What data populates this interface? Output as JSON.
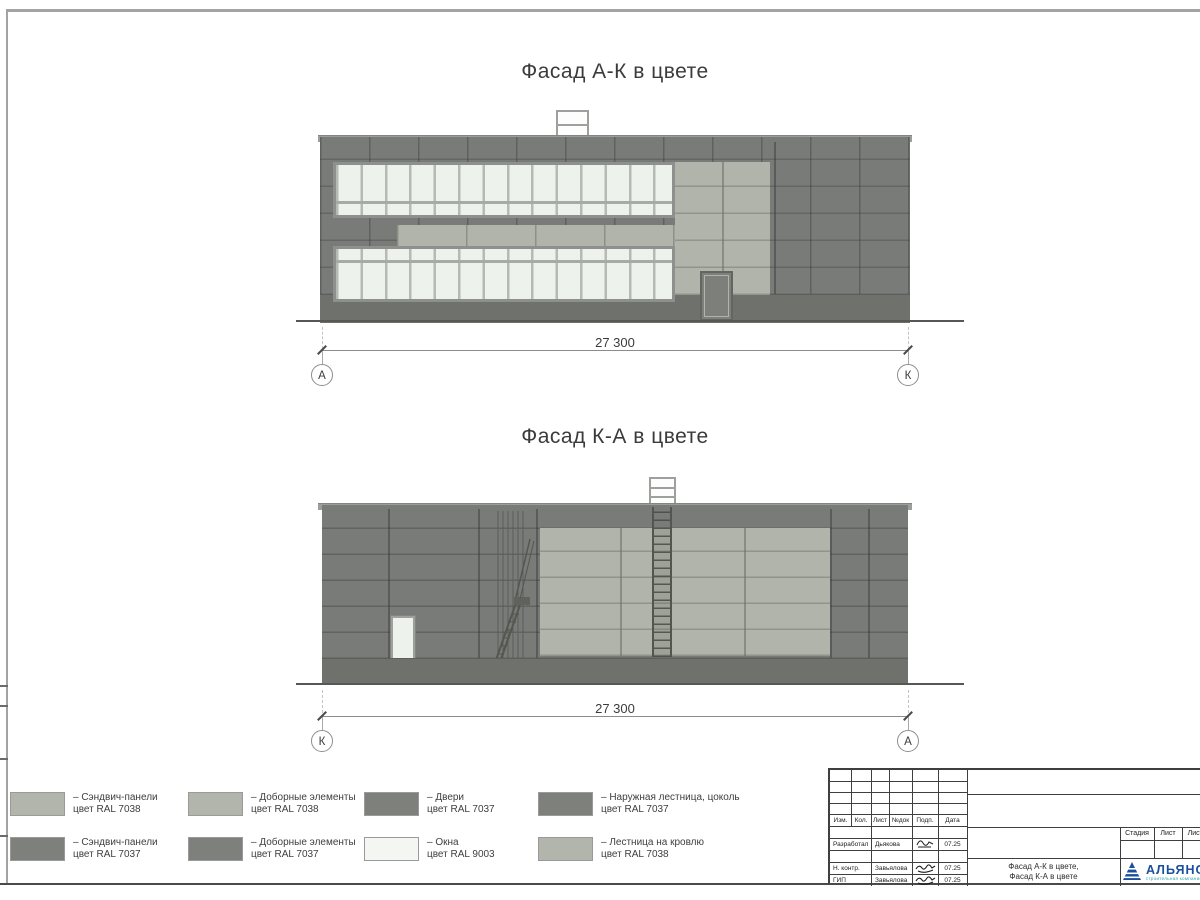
{
  "colors": {
    "panel_dark": "#787b77",
    "panel_light": "#b0b4aa",
    "window_pane": "#eef2ec",
    "window_frame": "#8d908c",
    "mullion": "#b6bab3",
    "plinth": "#6e716c",
    "door": "#7c7f7a",
    "ground": "#565854",
    "dim_line": "#8c8c8c",
    "text": "#3c3c3c",
    "frame_gray": "#a3a3a3",
    "frame_dark": "#4a4a4a",
    "tb_line": "#3f3f3f",
    "logo_blue": "#1b4f9e",
    "logo_teal": "#2ba4ad",
    "swatch_light": "#b2b5ac",
    "swatch_dark": "#7d807b",
    "swatch_white": "#f4f6f1"
  },
  "facade1": {
    "title": "Фасад А-К в цвете",
    "dimension": "27 300",
    "axis_left": "А",
    "axis_right": "К"
  },
  "facade2": {
    "title": "Фасад К-А в цвете",
    "dimension": "27 300",
    "axis_left": "К",
    "axis_right": "А"
  },
  "legend": {
    "items": [
      {
        "type": "light",
        "line1": "– Сэндвич-панели",
        "line2": "цвет RAL 7038"
      },
      {
        "type": "dark",
        "line1": "– Сэндвич-панели",
        "line2": "цвет RAL 7037"
      },
      {
        "type": "light",
        "line1": "– Доборные элементы",
        "line2": "цвет RAL 7038"
      },
      {
        "type": "dark",
        "line1": "– Доборные элементы",
        "line2": "цвет RAL 7037"
      },
      {
        "type": "dark",
        "line1": "– Двери",
        "line2": "цвет RAL 7037"
      },
      {
        "type": "white",
        "line1": "– Окна",
        "line2": "цвет RAL 9003"
      },
      {
        "type": "dark",
        "line1": "– Наружная лестница, цоколь",
        "line2": "цвет RAL 7037"
      },
      {
        "type": "light",
        "line1": "– Лестница на кровлю",
        "line2": "цвет RAL 7038"
      }
    ]
  },
  "titleblock": {
    "col_headers": [
      "Изм.",
      "Кол.",
      "Лист",
      "№док",
      "Подп.",
      "Дата"
    ],
    "rows": [
      {
        "role": "Разработал",
        "name": "Дьякова",
        "date": "07.25"
      },
      {
        "role": "Н. контр.",
        "name": "Завьялова",
        "date": "07.25"
      },
      {
        "role": "ГИП",
        "name": "Завьялова",
        "date": "07.25"
      }
    ],
    "doc_title_line1": "Фасад А-К в цвете,",
    "doc_title_line2": "Фасад К-А в цвете",
    "stage_header": "Стадия",
    "sheet_header": "Лист",
    "sheets_header": "Листов",
    "company_name": "АЛЬЯНС",
    "company_sub": "строительная компания"
  }
}
